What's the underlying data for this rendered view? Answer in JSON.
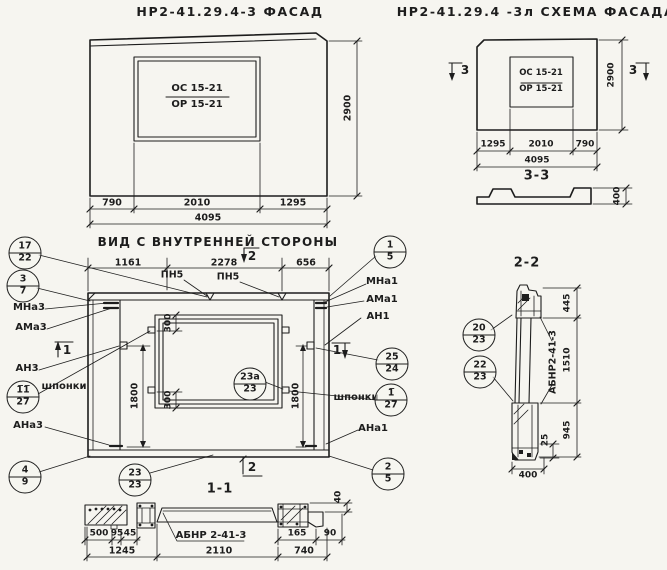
{
  "colors": {
    "paper": "#f6f5f0",
    "ink": "#1d1d1d"
  },
  "titles": {
    "facade": "НР2-41.29.4-3    ФАСАД",
    "scheme": "НР2-41.29.4 -3л   СХЕМА ФАСАДА",
    "inner_view": "ВИД С ВНУТРЕННЕЙ СТОРОНЫ",
    "section_3_3": "3-3",
    "section_2_2": "2-2",
    "section_1_1": "1-1"
  },
  "window_mark": {
    "top": "ОС 15-21",
    "bottom": "ОР 15-21"
  },
  "facade": {
    "dim_left": "790",
    "dim_mid": "2010",
    "dim_right": "1295",
    "dim_total": "4095",
    "dim_height": "2900"
  },
  "scheme": {
    "dim_left": "1295",
    "dim_mid": "2010",
    "dim_right": "790",
    "dim_total": "4095",
    "dim_height": "2900",
    "flag_left": "3",
    "flag_right": "3",
    "profile_dim": "400"
  },
  "view": {
    "dim_top_left": "1161",
    "dim_top_mid": "2278",
    "dim_top_right": "656",
    "pn_left": "ПН5",
    "pn_right": "ПН5",
    "dim_300_top": "300",
    "dim_300_bottom": "300",
    "dim_1800_left": "1800",
    "dim_1800_right": "1800",
    "mark_top": "2",
    "mark_bottom": "2",
    "mark_left": "1",
    "mark_right": "1",
    "lbl_mna3": "МНа3",
    "lbl_ama3": "АМа3",
    "lbl_an3": "АН3",
    "lbl_shponki_left": "шпонки",
    "lbl_ana3": "АНа3",
    "lbl_mna1": "МНа1",
    "lbl_ama1": "АМа1",
    "lbl_an1": "АН1",
    "lbl_shponki_right": "шпонки",
    "lbl_ana1": "АНа1"
  },
  "callouts": {
    "c17_22": {
      "top": "17",
      "bottom": "22"
    },
    "c3_7": {
      "top": "3",
      "bottom": "7"
    },
    "c11o_27": {
      "top": "1̅1̅",
      "bottom": "27"
    },
    "c4_9": {
      "top": "4",
      "bottom": "9"
    },
    "c1_5": {
      "top": "1",
      "bottom": "5"
    },
    "c25_24": {
      "top": "25",
      "bottom": "24"
    },
    "c1o_27": {
      "top": "1̅",
      "bottom": "27"
    },
    "c2_5": {
      "top": "2",
      "bottom": "5"
    },
    "c23_23": {
      "top": "23",
      "bottom": "23"
    },
    "c23a_23": {
      "top": "23а",
      "bottom": "23"
    },
    "c20_23": {
      "top": "20",
      "bottom": "23"
    },
    "c22_23": {
      "top": "22",
      "bottom": "23"
    }
  },
  "s11": {
    "label": "АБНР 2-41-3",
    "d40": "40",
    "d500": "500",
    "d95": "95",
    "d45": "45",
    "d165": "165",
    "d90": "90",
    "d1245": "1245",
    "d2110": "2110",
    "d740": "740"
  },
  "s22": {
    "label": "АБНР2-41-3",
    "d445": "445",
    "d1510": "1510",
    "d945": "945",
    "d25": "25",
    "d400": "400"
  }
}
